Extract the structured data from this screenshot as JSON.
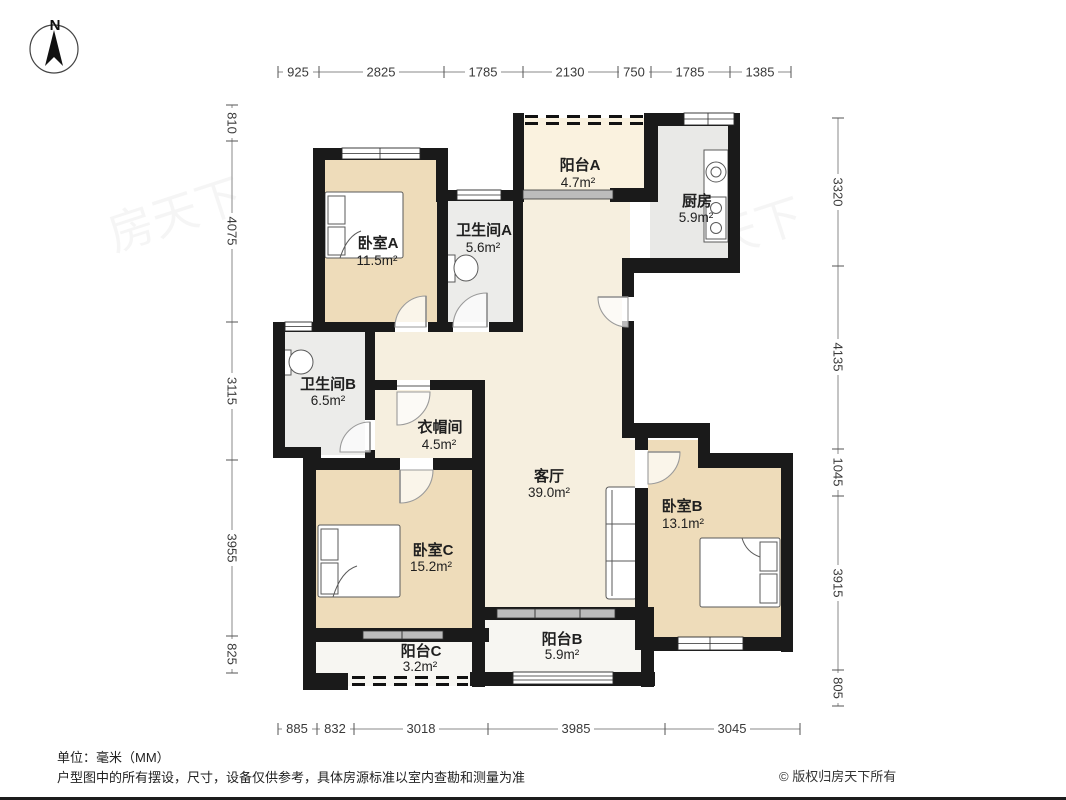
{
  "meta": {
    "compass_n": "N",
    "watermark": "房天下"
  },
  "footer": {
    "unit_note": "单位：毫米（MM）",
    "disclaimer": "户型图中的所有摆设，尺寸，设备仅供参考，具体房源标准以室内查勘和测量为准",
    "copyright": "© 版权归房天下所有"
  },
  "rooms": {
    "balcony_a": {
      "name": "阳台A",
      "area": "4.7m²"
    },
    "kitchen": {
      "name": "厨房",
      "area": "5.9m²"
    },
    "bedroom_a": {
      "name": "卧室A",
      "area": "11.5m²"
    },
    "bathroom_a": {
      "name": "卫生间A",
      "area": "5.6m²"
    },
    "bathroom_b": {
      "name": "卫生间B",
      "area": "6.5m²"
    },
    "cloakroom": {
      "name": "衣帽间",
      "area": "4.5m²"
    },
    "living": {
      "name": "客厅",
      "area": "39.0m²"
    },
    "bedroom_b": {
      "name": "卧室B",
      "area": "13.1m²"
    },
    "bedroom_c": {
      "name": "卧室C",
      "area": "15.2m²"
    },
    "balcony_c": {
      "name": "阳台C",
      "area": "3.2m²"
    },
    "balcony_b": {
      "name": "阳台B",
      "area": "5.9m²"
    }
  },
  "dims": {
    "top": [
      "925",
      "2825",
      "1785",
      "2130",
      "750",
      "1785",
      "1385"
    ],
    "left": [
      "810",
      "4075",
      "3115",
      "3955",
      "825"
    ],
    "right": [
      "3320",
      "4135",
      "1045",
      "3915",
      "805"
    ],
    "bottom": [
      "885",
      "832",
      "3018",
      "3985",
      "3045"
    ]
  },
  "colors": {
    "wall": "#1a1a1a",
    "floor_living": "#f6efdf",
    "floor_bedroom": "#eedcba",
    "floor_bath": "#ececea",
    "floor_kitchen": "#e9e9e7",
    "floor_balcony_a": "#faf2df",
    "floor_balcony": "#f7f6f2",
    "sliding_band": "#bcbcbc"
  }
}
